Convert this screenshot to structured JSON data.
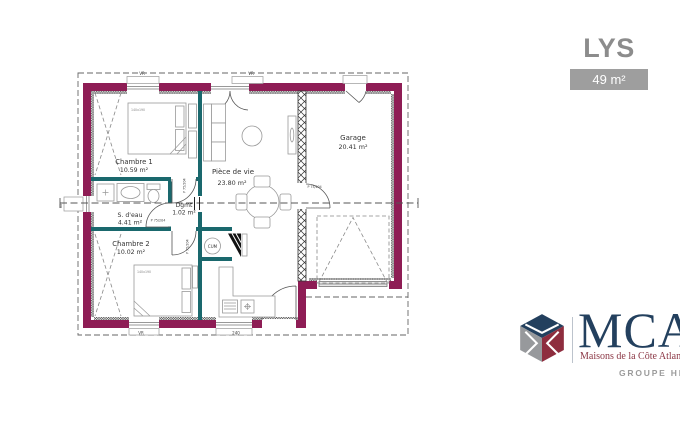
{
  "header": {
    "model_name": "LYS",
    "area_badge": "49 m²"
  },
  "plan": {
    "rooms": [
      {
        "name": "Chambre 1",
        "area": "10.59 m²"
      },
      {
        "name": "S. d'eau",
        "area": "4.41 m²"
      },
      {
        "name": "Chambre 2",
        "area": "10.02 m²"
      },
      {
        "name": "Dgmt",
        "area": "1.02 m²"
      },
      {
        "name": "Pièce de vie",
        "area": "23.80 m²"
      },
      {
        "name": "Garage",
        "area": "20.41 m²"
      }
    ],
    "equipment": {
      "water_heater": "CUM"
    },
    "door_label": "P 75/204",
    "bed_label": "140x190",
    "window_labels": {
      "vr": "VR",
      "kitchen": "240",
      "bathroom": "60"
    }
  },
  "branding": {
    "logo": "MCA",
    "tagline": "Maisons de la Côte Atlantique",
    "group": "GROUPE HEXAOM"
  },
  "colors": {
    "wall": "#8e1d55",
    "partition": "#1a686d",
    "badge_bg": "#9e9e9e",
    "title_gray": "#8c8c8c",
    "brand_navy": "#23405e",
    "brand_gray": "#97999c",
    "brand_maroon": "#8e2d3e",
    "tagline_red": "#8b3644"
  }
}
